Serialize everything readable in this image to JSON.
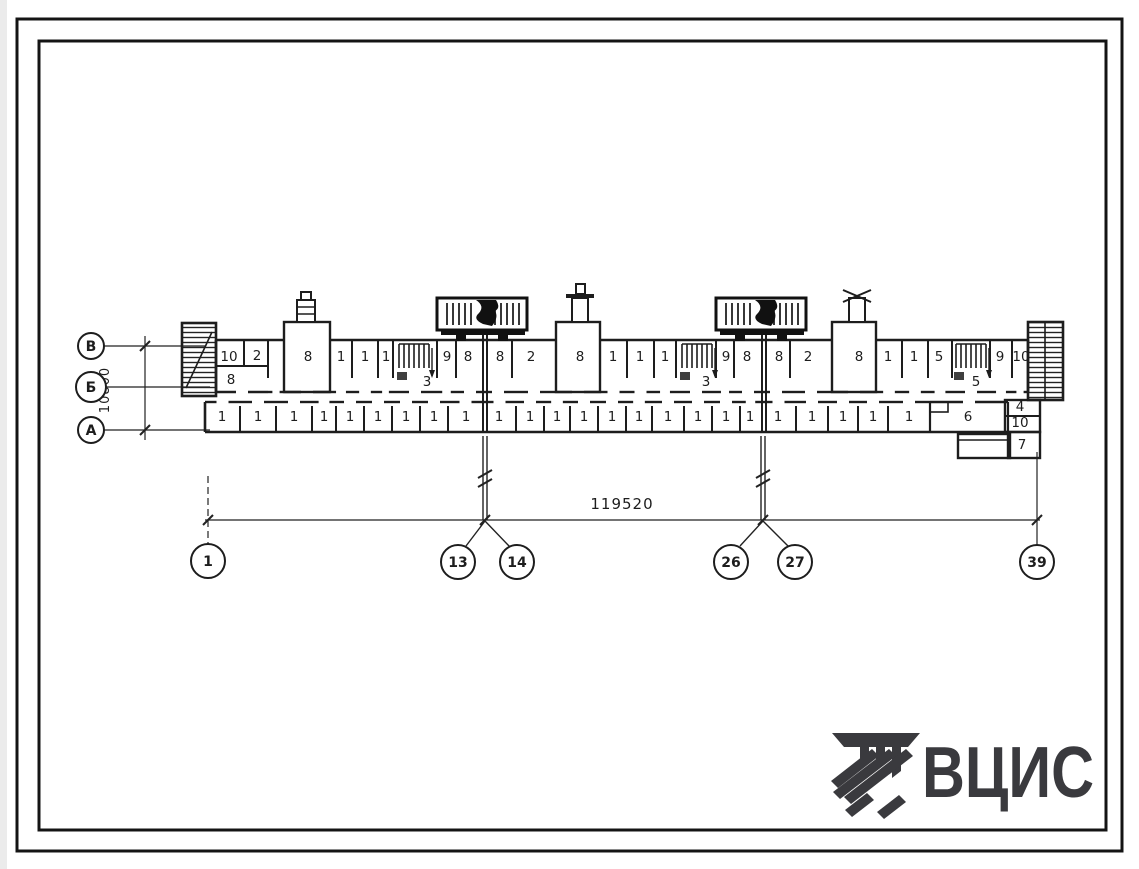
{
  "drawing": {
    "title": "floor-plan",
    "total_length_dim": "119520",
    "depth_dim": "10800"
  },
  "axis_bubbles": [
    {
      "label": "В",
      "cx": 91,
      "cy": 346,
      "r": 13
    },
    {
      "label": "Б",
      "cx": 91,
      "cy": 387,
      "r": 15
    },
    {
      "label": "А",
      "cx": 91,
      "cy": 430,
      "r": 13
    }
  ],
  "grid_bubbles": [
    {
      "label": "1",
      "cx": 208,
      "cy": 561,
      "r": 17
    },
    {
      "label": "13",
      "cx": 458,
      "cy": 562,
      "r": 17
    },
    {
      "label": "14",
      "cx": 517,
      "cy": 562,
      "r": 17
    },
    {
      "label": "26",
      "cx": 731,
      "cy": 562,
      "r": 17
    },
    {
      "label": "27",
      "cx": 795,
      "cy": 562,
      "r": 17
    },
    {
      "label": "39",
      "cx": 1037,
      "cy": 562,
      "r": 17
    }
  ],
  "plan_labels": {
    "top": [
      {
        "t": "10",
        "x": 229,
        "y": 361
      },
      {
        "t": "2",
        "x": 257,
        "y": 360
      },
      {
        "t": "8",
        "x": 231,
        "y": 384
      },
      {
        "t": "8",
        "x": 308,
        "y": 361
      },
      {
        "t": "1",
        "x": 341,
        "y": 361
      },
      {
        "t": "1",
        "x": 365,
        "y": 361
      },
      {
        "t": "1",
        "x": 386,
        "y": 361
      },
      {
        "t": "3",
        "x": 427,
        "y": 386
      },
      {
        "t": "9",
        "x": 447,
        "y": 361
      },
      {
        "t": "8",
        "x": 468,
        "y": 361
      },
      {
        "t": "8",
        "x": 500,
        "y": 361
      },
      {
        "t": "2",
        "x": 531,
        "y": 361
      },
      {
        "t": "8",
        "x": 580,
        "y": 361
      },
      {
        "t": "1",
        "x": 613,
        "y": 361
      },
      {
        "t": "1",
        "x": 640,
        "y": 361
      },
      {
        "t": "1",
        "x": 665,
        "y": 361
      },
      {
        "t": "3",
        "x": 706,
        "y": 386
      },
      {
        "t": "9",
        "x": 726,
        "y": 361
      },
      {
        "t": "8",
        "x": 747,
        "y": 361
      },
      {
        "t": "8",
        "x": 779,
        "y": 361
      },
      {
        "t": "2",
        "x": 808,
        "y": 361
      },
      {
        "t": "8",
        "x": 859,
        "y": 361
      },
      {
        "t": "1",
        "x": 888,
        "y": 361
      },
      {
        "t": "1",
        "x": 914,
        "y": 361
      },
      {
        "t": "5",
        "x": 939,
        "y": 361
      },
      {
        "t": "5",
        "x": 976,
        "y": 386
      },
      {
        "t": "9",
        "x": 1000,
        "y": 361
      },
      {
        "t": "10",
        "x": 1021,
        "y": 361
      }
    ],
    "bottom": [
      {
        "t": "1",
        "x": 222,
        "y": 421
      },
      {
        "t": "1",
        "x": 258,
        "y": 421
      },
      {
        "t": "1",
        "x": 294,
        "y": 421
      },
      {
        "t": "1",
        "x": 324,
        "y": 421
      },
      {
        "t": "1",
        "x": 350,
        "y": 421
      },
      {
        "t": "1",
        "x": 378,
        "y": 421
      },
      {
        "t": "1",
        "x": 406,
        "y": 421
      },
      {
        "t": "1",
        "x": 434,
        "y": 421
      },
      {
        "t": "1",
        "x": 466,
        "y": 421
      },
      {
        "t": "1",
        "x": 499,
        "y": 421
      },
      {
        "t": "1",
        "x": 530,
        "y": 421
      },
      {
        "t": "1",
        "x": 557,
        "y": 421
      },
      {
        "t": "1",
        "x": 584,
        "y": 421
      },
      {
        "t": "1",
        "x": 612,
        "y": 421
      },
      {
        "t": "1",
        "x": 639,
        "y": 421
      },
      {
        "t": "1",
        "x": 668,
        "y": 421
      },
      {
        "t": "1",
        "x": 698,
        "y": 421
      },
      {
        "t": "1",
        "x": 726,
        "y": 421
      },
      {
        "t": "1",
        "x": 750,
        "y": 421
      },
      {
        "t": "1",
        "x": 778,
        "y": 421
      },
      {
        "t": "1",
        "x": 812,
        "y": 421
      },
      {
        "t": "1",
        "x": 843,
        "y": 421
      },
      {
        "t": "1",
        "x": 873,
        "y": 421
      },
      {
        "t": "1",
        "x": 909,
        "y": 421
      },
      {
        "t": "6",
        "x": 968,
        "y": 421
      },
      {
        "t": "4",
        "x": 1020,
        "y": 411
      },
      {
        "t": "10",
        "x": 1020,
        "y": 427
      },
      {
        "t": "7",
        "x": 1022,
        "y": 449
      }
    ]
  },
  "logo": {
    "text": "ВЦИС",
    "color": "#3a3a3e"
  }
}
